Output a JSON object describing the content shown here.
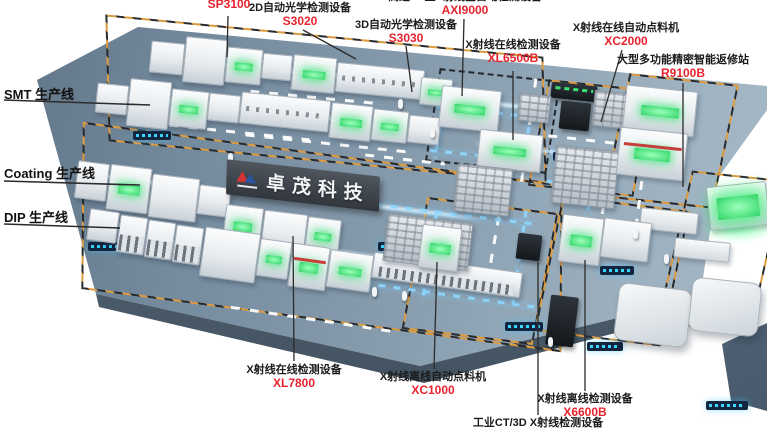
{
  "company_banner": {
    "text": "卓茂科技"
  },
  "line_labels": [
    {
      "id": "smt",
      "label": "SMT 生产线"
    },
    {
      "id": "coating",
      "label": "Coating 生产线"
    },
    {
      "id": "dip",
      "label": "DIP 生产线"
    }
  ],
  "equipment_callouts": [
    {
      "id": "sp3100",
      "name": "",
      "model": "SP3100"
    },
    {
      "id": "s3020",
      "name": "2D自动光学检测设备",
      "model": "S3020"
    },
    {
      "id": "s3030",
      "name": "3D自动光学检测设备",
      "model": "S3030"
    },
    {
      "id": "axi9000",
      "name": "高速CT型X射线全自动检测设备",
      "model": "AXI9000"
    },
    {
      "id": "xl6500b",
      "name": "X射线在线检测设备",
      "model": "XL6500B"
    },
    {
      "id": "xc2000",
      "name": "X射线在线自动点料机",
      "model": "XC2000"
    },
    {
      "id": "r9100b",
      "name": "大型多功能精密智能返修站",
      "model": "R9100B"
    },
    {
      "id": "xl7800",
      "name": "X射线在线检测设备",
      "model": "XL7800"
    },
    {
      "id": "xc1000",
      "name": "X射线离线自动点料机",
      "model": "XC1000"
    },
    {
      "id": "x6600b",
      "name": "X射线离线检测设备",
      "model": "X6600B"
    },
    {
      "id": "ct3d",
      "name": "工业CT/3D X射线检测设备",
      "model": ""
    }
  ],
  "colors": {
    "model_red": "#e8232e",
    "name_black": "#1b1b1b",
    "floor_blue_gray": "#7e94a6",
    "hazard_orange": "#dd9b3f",
    "path_blue": "#8fd8ff",
    "screen_green": "#2ed465"
  }
}
